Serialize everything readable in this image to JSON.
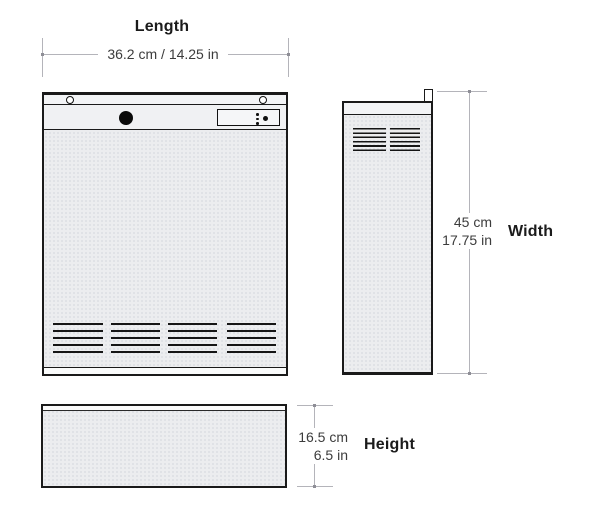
{
  "dimensions": {
    "length": {
      "label": "Length",
      "value": "36.2 cm / 14.25 in"
    },
    "width": {
      "label": "Width",
      "metric": "45 cm",
      "imperial": "17.75 in"
    },
    "height": {
      "label": "Height",
      "metric": "16.5 cm",
      "imperial": "6.5 in"
    }
  },
  "icons": [
    "screw-icon",
    "power-button-icon",
    "control-panel-icon",
    "vent-grille-icon",
    "mounting-flange-icon"
  ],
  "colors": {
    "outline": "#1a1a1a",
    "panel_fill": "#ecedef",
    "dimension_line": "#b4b4ba",
    "dimension_dot": "#8e8e96",
    "value_text": "#3c3c3c",
    "label_text": "#1b1b1b"
  }
}
